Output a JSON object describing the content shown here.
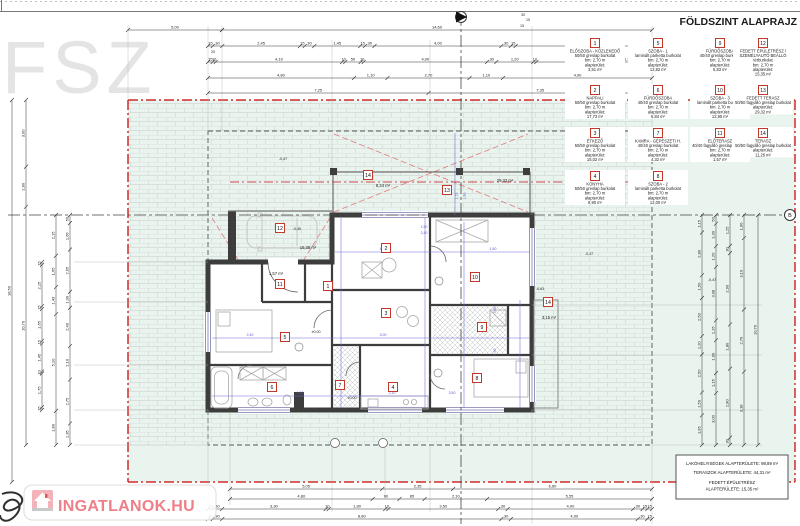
{
  "title": "FÖLDSZINT ALAPRAJZ",
  "corner_label": "FSZ",
  "watermark": {
    "text": "INGATLANOK.HU"
  },
  "section_marker_b": "B",
  "colors": {
    "yard_green": "#e9f4ef",
    "boundary_red": "#cf2b2b",
    "roof_red": "#e27b7b",
    "wall_dark": "#3d3d3d",
    "dim_blue": "#6c6cd8",
    "watermark_pink": "#ee7f88",
    "legend_box_red": "#c0392b"
  },
  "summary_box": {
    "line1": "LAKÓHELYISÉGEK ALAPTERÜLETE: 98,89 m²",
    "line2": "TERASZOK ALAPTERÜLETE: 44,31 m²",
    "line3": "FEDETT ÉPÜLETRÉSZ",
    "line4": "ALAPTERÜLETE: 15,35 m²"
  },
  "legend": [
    {
      "num": "1",
      "x": 595,
      "y": 43,
      "lines": [
        "ELŐSZOBA - KÖZLEKEDŐ",
        "50/50 greslap burkolat",
        "bm: 2,70 m",
        "alapterület:",
        "3,51 m²"
      ]
    },
    {
      "num": "5",
      "x": 658,
      "y": 43,
      "lines": [
        "SZOBA - 1",
        "laminált parketta burkolat",
        "bm: 2,70 m",
        "alapterület:",
        "12,82 m²"
      ]
    },
    {
      "num": "9",
      "x": 720,
      "y": 43,
      "lines": [
        "FÜRDŐSZOBA",
        "40/40 greslap burkolat",
        "bm: 2,70 m",
        "alapterület:",
        "5,83 m²"
      ]
    },
    {
      "num": "12",
      "x": 763,
      "y": 43,
      "lines": [
        "FEDETT ÉPÜLETRÉSZ /",
        "SZEMÉLYAUTÓ BEÁLLÓ",
        "térburkolat",
        "bm: 2,70 m",
        "alapterület:",
        "15,35 m²"
      ]
    },
    {
      "num": "2",
      "x": 595,
      "y": 90,
      "lines": [
        "NAPPALI",
        "50/50 greslap burkolat",
        "bm: 2,70 m",
        "alapterület:",
        "17,73 m²"
      ]
    },
    {
      "num": "6",
      "x": 658,
      "y": 90,
      "lines": [
        "FÜRDŐSZOBA",
        "40/40 greslap burkolat",
        "bm: 2,70 m",
        "alapterület:",
        "6,84 m²"
      ]
    },
    {
      "num": "10",
      "x": 720,
      "y": 90,
      "lines": [
        "SZOBA - 3",
        "laminált parketta burkolat",
        "bm: 2,70 m",
        "alapterület:",
        "12,90 m²"
      ]
    },
    {
      "num": "13",
      "x": 763,
      "y": 90,
      "lines": [
        "FEDETT TERASZ",
        "50/50 fagyálló greslap burkolat",
        "alapterület:",
        "29,32 m²"
      ]
    },
    {
      "num": "3",
      "x": 595,
      "y": 133,
      "lines": [
        "ÉTKEZŐ",
        "50/50 greslap burkolat",
        "bm: 2,70 m",
        "alapterület:",
        "15,02 m²"
      ]
    },
    {
      "num": "7",
      "x": 658,
      "y": 133,
      "lines": [
        "KAMRA - GÉPÉSZETI H.",
        "40/40 greslap burkolat",
        "bm: 2,70 m",
        "alapterület:",
        "4,32 m²"
      ]
    },
    {
      "num": "11",
      "x": 720,
      "y": 133,
      "lines": [
        "ELŐTERASZ",
        "40/40 fagyálló greslap burkolat",
        "bm: 2,70 m",
        "alapterület:",
        "1,57 m²"
      ]
    },
    {
      "num": "14",
      "x": 763,
      "y": 133,
      "lines": [
        "TERASZ",
        "50/50 fagyálló greslap burkolat",
        "alapterület:",
        "11,26 m²"
      ]
    },
    {
      "num": "4",
      "x": 595,
      "y": 176,
      "lines": [
        "KONYHA",
        "50/50 greslap burkolat",
        "bm: 2,70 m",
        "alapterület:",
        "8,90 m²"
      ]
    },
    {
      "num": "8",
      "x": 658,
      "y": 176,
      "lines": [
        "SZOBA - 2",
        "laminált parketta burkolat",
        "bm: 2,70 m",
        "alapterület:",
        "12,00 m²"
      ]
    }
  ],
  "room_markers": [
    {
      "n": "1",
      "x": 328,
      "y": 286
    },
    {
      "n": "2",
      "x": 386,
      "y": 248
    },
    {
      "n": "3",
      "x": 386,
      "y": 313
    },
    {
      "n": "4",
      "x": 393,
      "y": 387
    },
    {
      "n": "5",
      "x": 285,
      "y": 337
    },
    {
      "n": "6",
      "x": 272,
      "y": 387
    },
    {
      "n": "7",
      "x": 340,
      "y": 385
    },
    {
      "n": "8",
      "x": 477,
      "y": 378
    },
    {
      "n": "9",
      "x": 482,
      "y": 327
    },
    {
      "n": "10",
      "x": 475,
      "y": 277
    },
    {
      "n": "11",
      "x": 280,
      "y": 284
    },
    {
      "n": "12",
      "x": 280,
      "y": 228
    },
    {
      "n": "13",
      "x": 447,
      "y": 190
    },
    {
      "n": "14",
      "x": 368,
      "y": 175
    },
    {
      "n": "14",
      "x": 548,
      "y": 302
    }
  ],
  "plan_texts": [
    {
      "t": "15,35 m²",
      "x": 308,
      "y": 249
    },
    {
      "t": "1,57 m²",
      "x": 276,
      "y": 275
    },
    {
      "t": "8,24 m²",
      "x": 383,
      "y": 187
    },
    {
      "t": "29,32 m²",
      "x": 505,
      "y": 182
    },
    {
      "t": "3,15 m²",
      "x": 549,
      "y": 319
    },
    {
      "t": "-0,47",
      "x": 283,
      "y": 160,
      "s": 3.6
    },
    {
      "t": "-0,45",
      "x": 297,
      "y": 230,
      "s": 3.6
    },
    {
      "t": "±0,00",
      "x": 316,
      "y": 333,
      "s": 3.6
    },
    {
      "t": "±0,00",
      "x": 352,
      "y": 399,
      "s": 3.6
    },
    {
      "t": "-0,63",
      "x": 540,
      "y": 290,
      "s": 3.6
    },
    {
      "t": "-0,47",
      "x": 589,
      "y": 255,
      "s": 3.6
    },
    {
      "t": "-0,47",
      "x": 712,
      "y": 281,
      "s": 3.6
    },
    {
      "t": "20",
      "x": 213,
      "y": 53,
      "s": 3.6
    },
    {
      "t": "30",
      "x": 523,
      "y": 16,
      "s": 3.6
    },
    {
      "t": "15",
      "x": 528,
      "y": 21,
      "s": 3.6
    },
    {
      "t": "15",
      "x": 522,
      "y": 27,
      "s": 3.6
    }
  ],
  "dim_chains": [
    {
      "o": "h",
      "x1": 128,
      "x2": 222,
      "y": 30,
      "labels": [
        "5,00"
      ]
    },
    {
      "o": "h",
      "x1": 222,
      "x2": 652,
      "y": 30,
      "labels": [
        "14,60"
      ]
    },
    {
      "o": "h",
      "x1": 208,
      "x2": 652,
      "y": 46,
      "labels": [
        "15",
        "30",
        "2,45",
        "15",
        "30",
        "1,45",
        "15",
        "30",
        "4,00",
        "30",
        "15",
        "3,85",
        "30",
        "15"
      ]
    },
    {
      "o": "h",
      "x1": 208,
      "x2": 652,
      "y": 62,
      "labels": [
        "15",
        "10",
        "4,10",
        "10",
        "50",
        "10",
        "4,00",
        "30",
        "1,20",
        "10",
        "2,10",
        "10",
        "1,55"
      ]
    },
    {
      "o": "h",
      "x1": 208,
      "x2": 652,
      "y": 78,
      "labels": [
        "4,80",
        "1,10",
        "2,70",
        "1,10",
        "4,90"
      ]
    },
    {
      "o": "h",
      "x1": 208,
      "x2": 652,
      "y": 93,
      "labels": [
        "7,25",
        "7,35"
      ]
    },
    {
      "o": "h",
      "x1": 230,
      "x2": 652,
      "y": 489,
      "labels": [
        "5,05",
        "2,35",
        "6,60"
      ]
    },
    {
      "o": "h",
      "x1": 230,
      "x2": 652,
      "y": 499,
      "labels": [
        "4,80",
        "90",
        "85",
        "2,10",
        "5,55"
      ]
    },
    {
      "o": "h",
      "x1": 208,
      "x2": 652,
      "y": 509,
      "labels": [
        "15",
        "30",
        "3,30",
        "10",
        "1,80",
        "10",
        "3,50",
        "30",
        "4,00",
        "30",
        "15",
        "15"
      ]
    },
    {
      "o": "h",
      "x1": 208,
      "x2": 652,
      "y": 519,
      "labels": [
        "15",
        "30",
        "8,80",
        "30",
        "4,00",
        "30",
        "15"
      ]
    },
    {
      "o": "v",
      "x": 12,
      "y1": 100,
      "y2": 482,
      "labels": [
        "18,50"
      ]
    },
    {
      "o": "v",
      "x": 26,
      "y1": 100,
      "y2": 445,
      "labels": [
        "3,00",
        "1,80",
        "10,70"
      ]
    },
    {
      "o": "v",
      "x": 42,
      "y1": 262,
      "y2": 410,
      "labels": [
        "15",
        "2,15",
        "15",
        "1,65",
        "15",
        "1,45",
        "10",
        "1,75",
        "15"
      ]
    },
    {
      "o": "v",
      "x": 56,
      "y1": 215,
      "y2": 445,
      "labels": [
        "2,15",
        "1,65",
        "1,43",
        "5,10",
        "1,80"
      ]
    },
    {
      "o": "v",
      "x": 70,
      "y1": 215,
      "y2": 445,
      "labels": [
        "50",
        "1,66",
        "2,65",
        "1,00",
        "2,40",
        "2,10",
        "2,75",
        "1,35"
      ]
    },
    {
      "o": "v",
      "x": 702,
      "y1": 215,
      "y2": 445,
      "labels": [
        "1,15",
        "2,80",
        "1,50",
        "2,50",
        "1,20",
        "2,50",
        "1,50",
        "1,95"
      ]
    },
    {
      "o": "v",
      "x": 716,
      "y1": 215,
      "y2": 445,
      "labels": [
        "50",
        "1,30",
        "1,20",
        "3,08",
        "1,15",
        "1,90",
        "1,15",
        "3,00"
      ]
    },
    {
      "o": "v",
      "x": 730,
      "y1": 215,
      "y2": 445,
      "labels": [
        "1,25",
        "30",
        "2,90",
        "1,80",
        "2,80",
        "30"
      ]
    },
    {
      "o": "v",
      "x": 744,
      "y1": 215,
      "y2": 445,
      "labels": [
        "1,00",
        "3,10",
        "2,70",
        "3,18"
      ]
    },
    {
      "o": "v",
      "x": 758,
      "y1": 215,
      "y2": 445,
      "labels": [
        "10,70"
      ]
    }
  ],
  "blue_dims": {
    "lines": [
      [
        341,
        218,
        341,
        408
      ],
      [
        425,
        218,
        425,
        408
      ],
      [
        464,
        222,
        464,
        408
      ],
      [
        520,
        300,
        520,
        408
      ],
      [
        335,
        252,
        530,
        252
      ],
      [
        212,
        338,
        530,
        338
      ],
      [
        212,
        396,
        428,
        396
      ],
      [
        455,
        133,
        455,
        215
      ]
    ],
    "labels": [
      {
        "t": "4,00",
        "x": 383,
        "y": 250
      },
      {
        "t": "1,50",
        "x": 493,
        "y": 250
      },
      {
        "t": "2,40",
        "x": 250,
        "y": 336
      },
      {
        "t": "3,00",
        "x": 383,
        "y": 336
      },
      {
        "t": "3,08",
        "x": 496,
        "y": 310,
        "r": 1
      },
      {
        "t": "1,90",
        "x": 496,
        "y": 352,
        "r": 1
      },
      {
        "t": "2,10",
        "x": 392,
        "y": 394
      },
      {
        "t": "1,20",
        "x": 300,
        "y": 394
      },
      {
        "t": "3,50",
        "x": 452,
        "y": 394
      },
      {
        "t": "1,50",
        "x": 424,
        "y": 228
      },
      {
        "t": "2,40",
        "x": 424,
        "y": 234
      },
      {
        "t": "1,75",
        "x": 458,
        "y": 196,
        "r": 1
      },
      {
        "t": "1,90",
        "x": 466,
        "y": 196,
        "r": 1
      }
    ]
  }
}
